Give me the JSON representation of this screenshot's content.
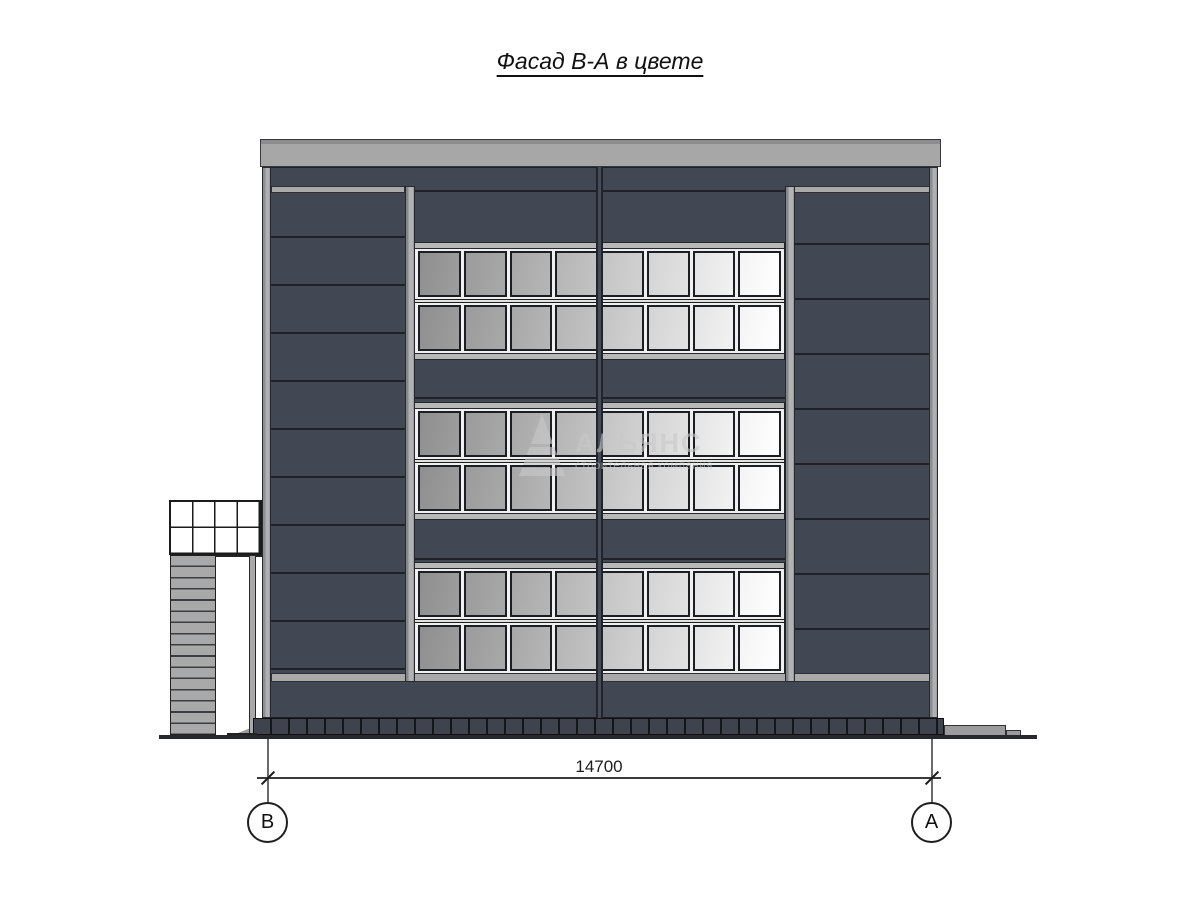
{
  "title": {
    "text": "Фасад В-А в цвете"
  },
  "watermark": {
    "name": "АЛЬЯНС",
    "subtitle": "строительная компания"
  },
  "dimension": {
    "value": "14700"
  },
  "axes": {
    "left": {
      "label": "В"
    },
    "right": {
      "label": "А"
    }
  },
  "facade": {
    "bands": 3,
    "rows_per_band": 2,
    "panes_per_row": 8,
    "pane_colors": [
      "#8f8f8f",
      "#9b9b9b",
      "#a8a8a8",
      "#b5b5b5",
      "#c4c4c4",
      "#d4d4d4",
      "#e4e4e4",
      "#f4f4f4"
    ],
    "colors": {
      "wall": "#414753",
      "roof": "#a7a7a7",
      "pilaster": "#a9a9a9",
      "frame": "#b8b8b8",
      "plinth": "#3f434d",
      "ground": "#26282c"
    }
  }
}
